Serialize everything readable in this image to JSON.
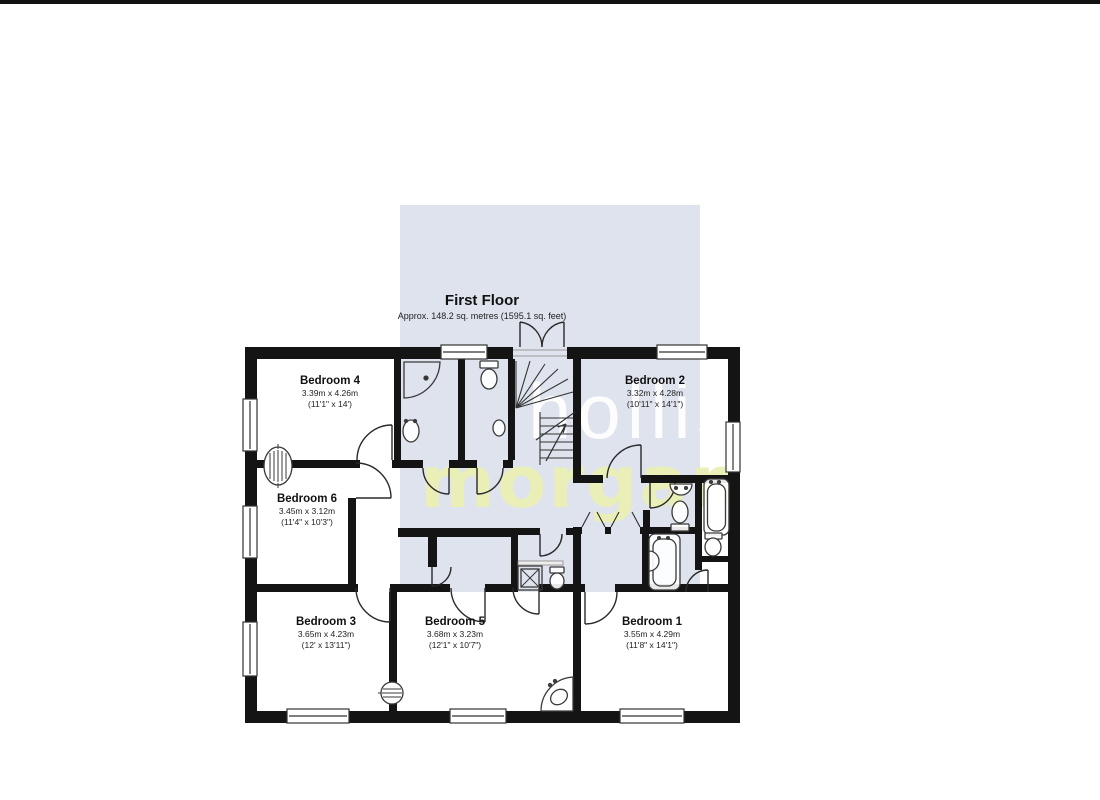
{
  "title": {
    "floor": "First Floor",
    "area": "Approx. 148.2 sq. metres (1595.1 sq. feet)"
  },
  "watermark": {
    "line1": "hollis",
    "line2": "morgan",
    "panel_color": "#dee3ed",
    "line1_color": "#ffffff",
    "line2_color": "#eaf0b5"
  },
  "rooms": [
    {
      "id": "bedroom4",
      "name": "Bedroom 4",
      "metric": "3.39m x 4.26m",
      "imperial": "(11'1\" x 14')"
    },
    {
      "id": "bedroom2",
      "name": "Bedroom 2",
      "metric": "3.32m x 4.28m",
      "imperial": "(10'11\" x 14'1\")"
    },
    {
      "id": "bedroom6",
      "name": "Bedroom 6",
      "metric": "3.45m x 3.12m",
      "imperial": "(11'4\" x 10'3\")"
    },
    {
      "id": "bedroom3",
      "name": "Bedroom 3",
      "metric": "3.65m x 4.23m",
      "imperial": "(12' x 13'11\")"
    },
    {
      "id": "bedroom5",
      "name": "Bedroom 5",
      "metric": "3.68m x 3.23m",
      "imperial": "(12'1\" x 10'7\")"
    },
    {
      "id": "bedroom1",
      "name": "Bedroom 1",
      "metric": "3.55m x 4.29m",
      "imperial": "(11'8\" x 14'1\")"
    }
  ],
  "plan_colors": {
    "wall": "#141414",
    "fixture_stroke": "#3a3a3a",
    "window_fill": "#ffffff"
  }
}
